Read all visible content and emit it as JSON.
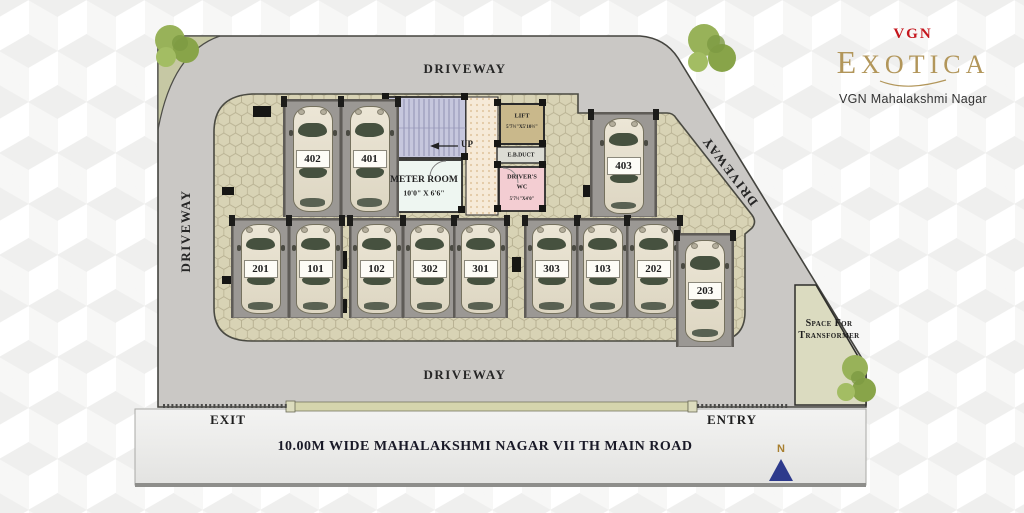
{
  "branding": {
    "brand": "VGN",
    "name": "EXOTICA",
    "tagline": "VGN Mahalakshmi Nagar",
    "brand_color": "#c5161d",
    "gold": "#b2965a"
  },
  "compass": {
    "north": "N"
  },
  "road": {
    "name": "10.00M WIDE MAHALAKSHMI NAGAR VII TH MAIN ROAD"
  },
  "gates": {
    "exit": "EXIT",
    "entry": "ENTRY"
  },
  "driveway": {
    "top": "DRIVEWAY",
    "left": "DRIVEWAY",
    "right": "DRIVEWAY",
    "bottom": "DRIVEWAY"
  },
  "transformer": {
    "line1": "Space For",
    "line2": "Transformer"
  },
  "rooms": {
    "stair_up": "UP",
    "meter_name": "METER ROOM",
    "meter_dims": "10'0\" X 6'6\"",
    "lift_name": "LIFT",
    "lift_dims": "5'7½\"X5'10½\"",
    "duct_name": "E.B.DUCT",
    "wc_line1": "DRIVER'S",
    "wc_line2": "WC",
    "wc_dims": "5'7½\"X4'0\""
  },
  "parking_spots": [
    {
      "label": "402"
    },
    {
      "label": "401"
    },
    {
      "label": "403"
    },
    {
      "label": "201"
    },
    {
      "label": "101"
    },
    {
      "label": "102"
    },
    {
      "label": "302"
    },
    {
      "label": "301"
    },
    {
      "label": "303"
    },
    {
      "label": "103"
    },
    {
      "label": "202"
    },
    {
      "label": "203"
    }
  ],
  "colors": {
    "driveway": "#cac8c5",
    "paving": "#d8d3b5",
    "stall": "#9b9894",
    "transformer_area": "#dbdbc0",
    "compass_navy": "#2d3a8c",
    "tree_green": "#98b259"
  }
}
